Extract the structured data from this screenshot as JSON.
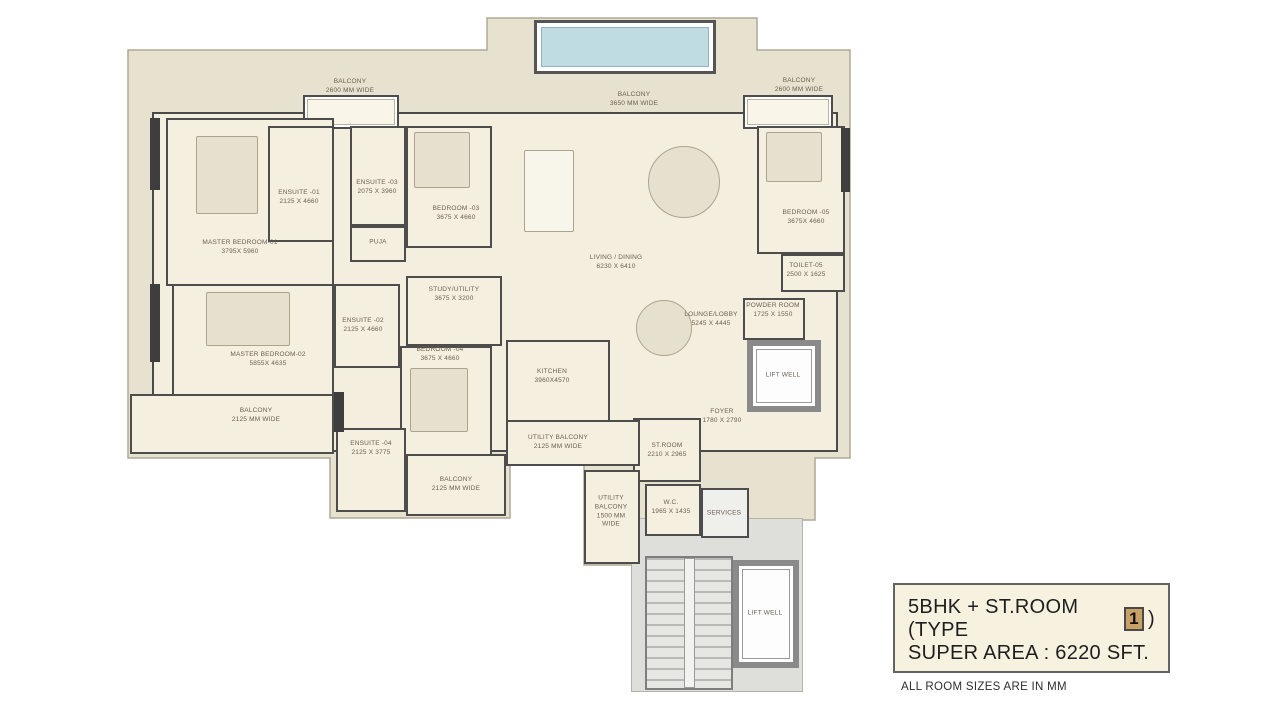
{
  "info_box": {
    "title_prefix": "5BHK + ST.ROOM (TYPE",
    "type_number": "1",
    "title_suffix": ")",
    "super_area": "SUPER AREA : 6220 SFT.",
    "footnote": "ALL ROOM SIZES ARE IN MM"
  },
  "rooms": [
    {
      "name": "MASTER BEDROOM-01",
      "dims": "3795X 5960"
    },
    {
      "name": "ENSUITE -01",
      "dims": "2125 X 4660"
    },
    {
      "name": "ENSUITE -03",
      "dims": "2075 X 3960"
    },
    {
      "name": "PUJA",
      "dims": ""
    },
    {
      "name": "BEDROOM -03",
      "dims": "3675 X 4660"
    },
    {
      "name": "LIVING / DINING",
      "dims": "6230 X 6410"
    },
    {
      "name": "BEDROOM -05",
      "dims": "3675X 4660"
    },
    {
      "name": "TOILET-05",
      "dims": "2500 X 1625"
    },
    {
      "name": "LOUNGE/LOBBY",
      "dims": "5245 X 4445"
    },
    {
      "name": "POWDER ROOM",
      "dims": "1725 X 1550"
    },
    {
      "name": "LIFT WELL",
      "dims": ""
    },
    {
      "name": "STUDY/UTILITY",
      "dims": "3675 X 3200"
    },
    {
      "name": "ENSUITE -02",
      "dims": "2125 X 4660"
    },
    {
      "name": "BEDROOM -04",
      "dims": "3675 X 4660"
    },
    {
      "name": "MASTER BEDROOM-02",
      "dims": "5855X 4635"
    },
    {
      "name": "KITCHEN",
      "dims": "3960X4570"
    },
    {
      "name": "FOYER",
      "dims": "1780 X 2790"
    },
    {
      "name": "ST.ROOM",
      "dims": "2210 X 2965"
    },
    {
      "name": "ENSUITE -04",
      "dims": "2125 X 3775"
    },
    {
      "name": "W.C.",
      "dims": "1965 X 1435"
    },
    {
      "name": "SERVICES",
      "dims": ""
    },
    {
      "name": "LIFT WELL",
      "dims": ""
    },
    {
      "name": "BALCONY",
      "dims": "2125 MM WIDE"
    },
    {
      "name": "BALCONY",
      "dims": "2125 MM WIDE"
    },
    {
      "name": "UTILITY BALCONY",
      "dims": "2125 MM WIDE"
    },
    {
      "name": "UTILITY BALCONY",
      "dims": "1500 MM WIDE"
    },
    {
      "name": "BALCONY",
      "dims": "2600 MM WIDE"
    },
    {
      "name": "BALCONY",
      "dims": "3650 MM WIDE"
    },
    {
      "name": "BALCONY",
      "dims": "2600 MM WIDE"
    }
  ],
  "colors": {
    "backdrop": "#e7e1d0",
    "floor": "#f4efde",
    "wall": "#4d4d4d",
    "pool": "#bedce1",
    "service_gray": "#dededb",
    "info_box_bg": "#f7f1e0",
    "type_badge_bg": "#c9a166",
    "label_text": "#6a6051"
  }
}
